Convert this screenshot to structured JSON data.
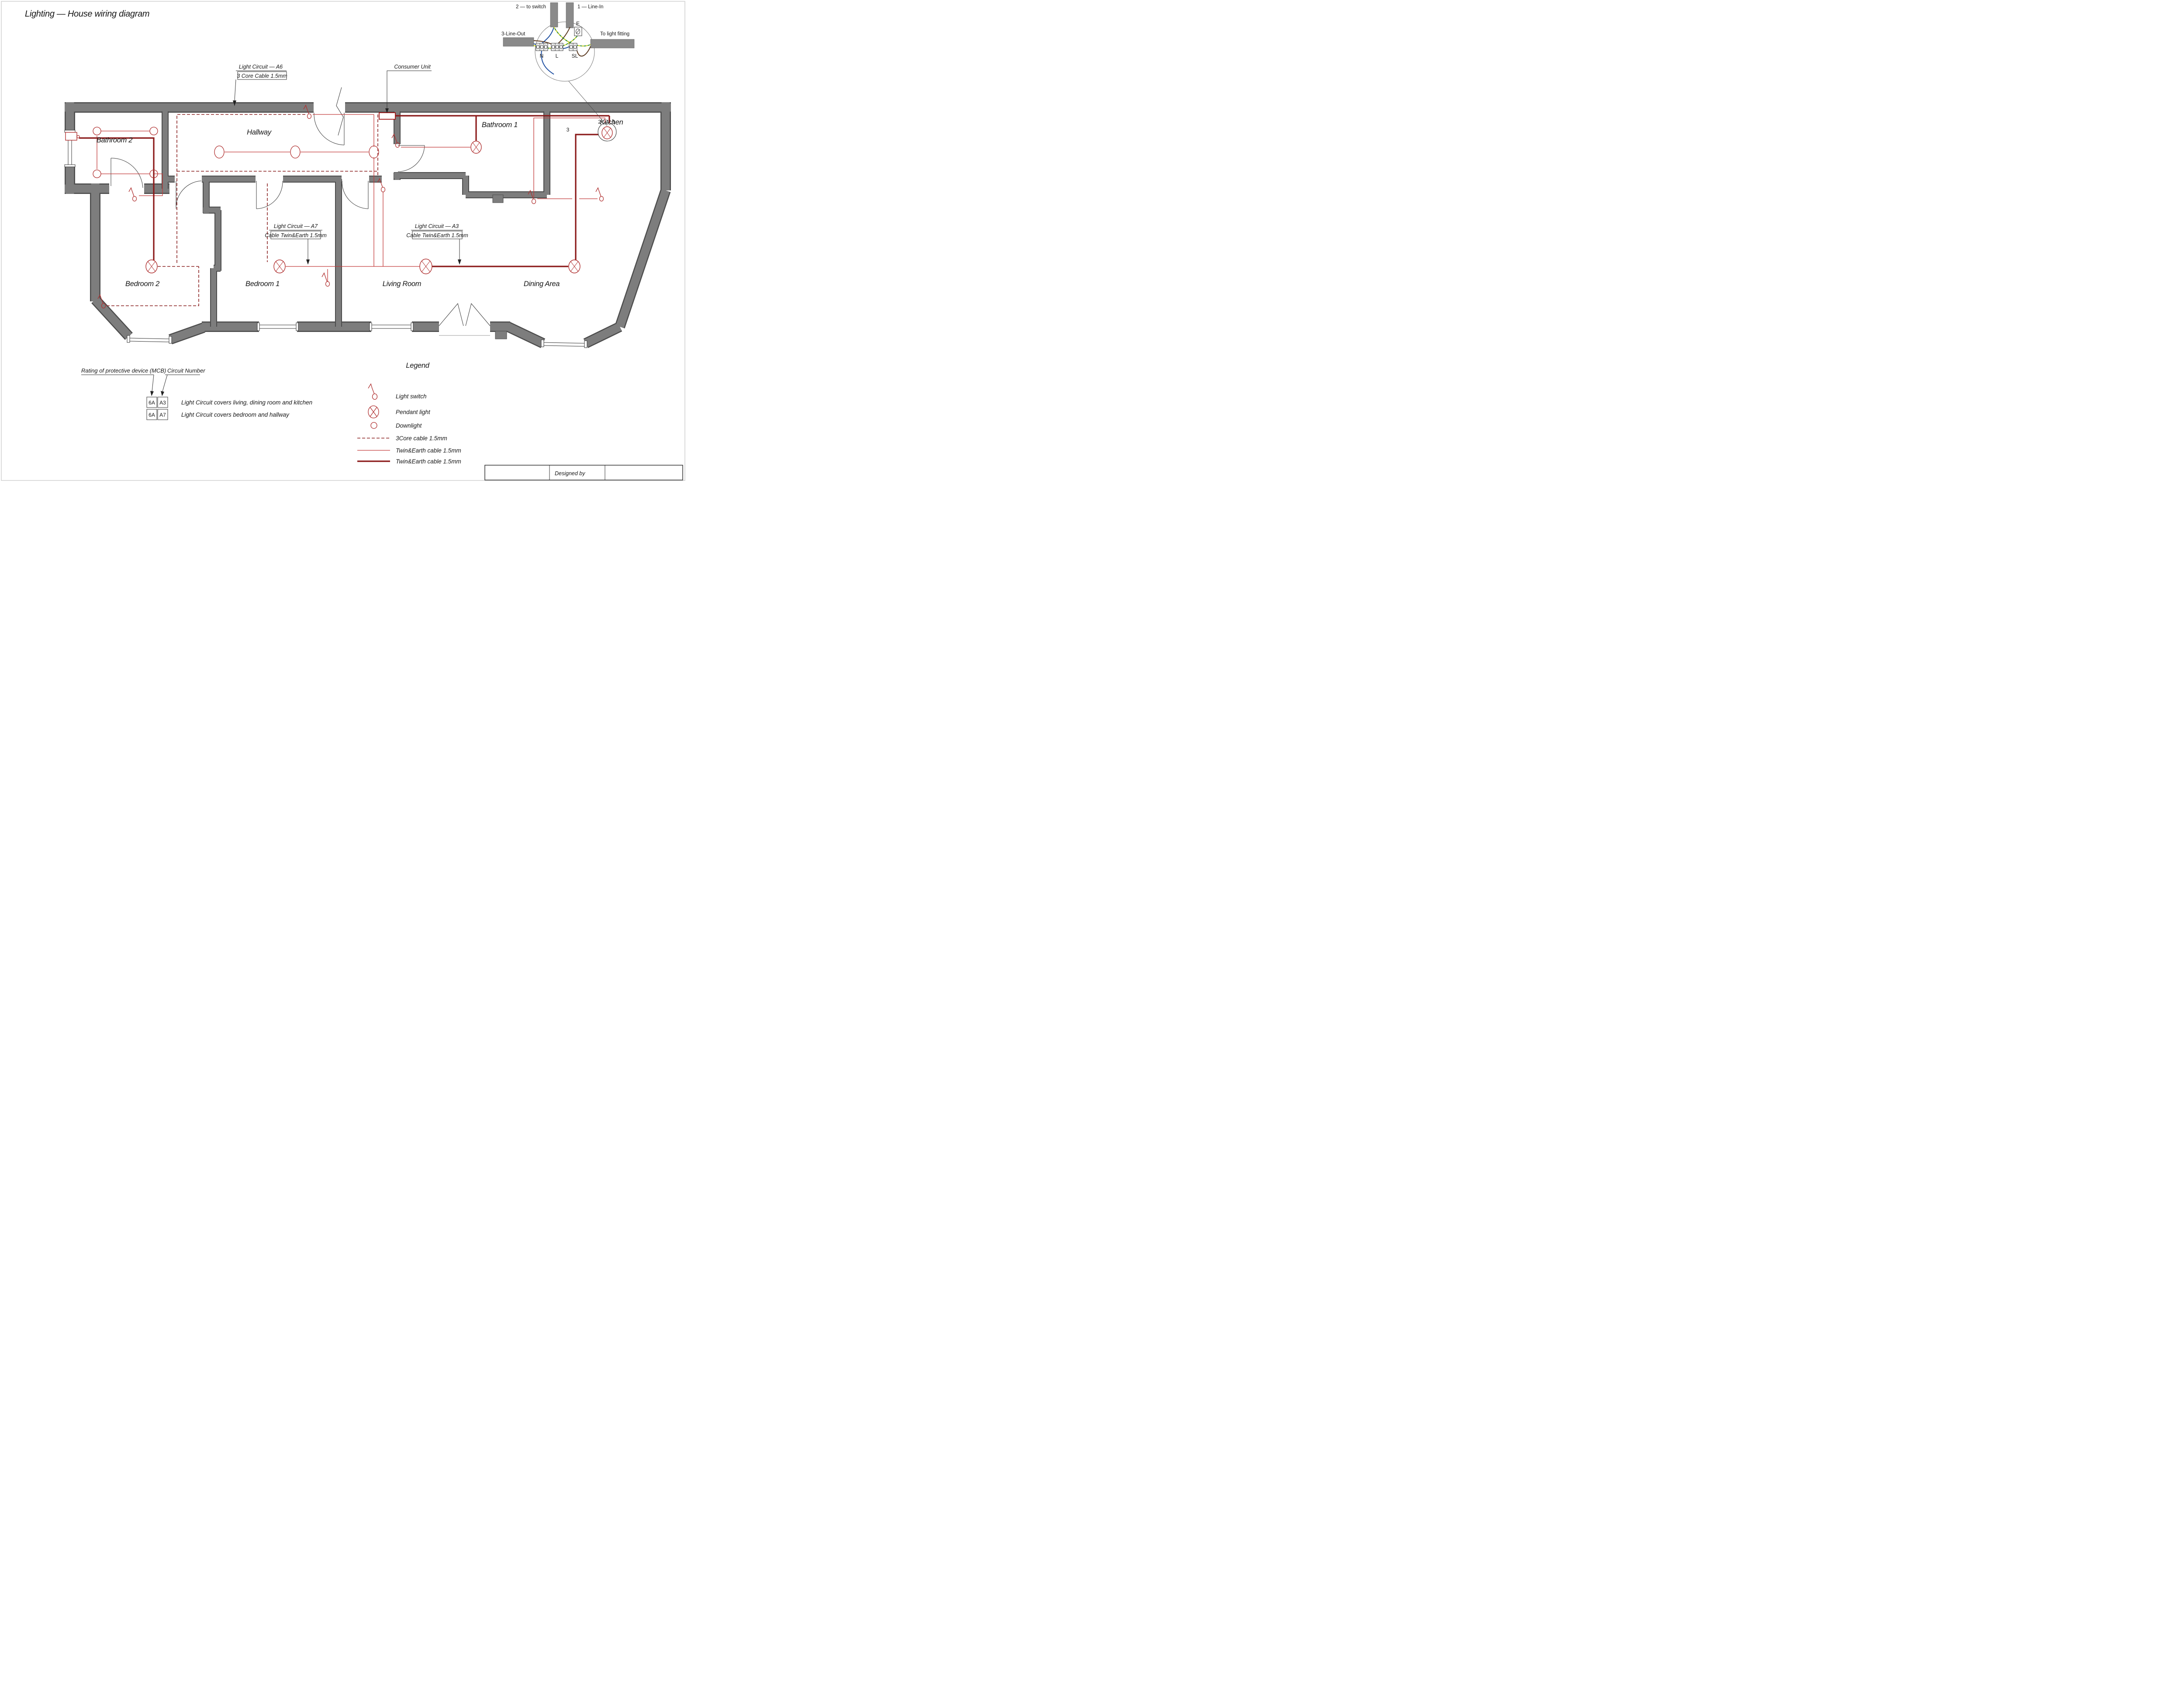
{
  "title": "Lighting — House wiring diagram",
  "ceiling_rose_detail": {
    "label_to_switch": "2 — to switch",
    "label_line_in": "1 — Line-In",
    "label_line_out": "3-Line-Out",
    "label_to_light_fitting": "To light fitting",
    "terminal_e": "E",
    "terminal_n": "N",
    "terminal_l": "L",
    "terminal_sl": "SL"
  },
  "callouts": {
    "a6_title": "Light Circuit — A6",
    "a6_sub": "3 Core Cable 1.5mm",
    "consumer_unit": "Consumer Unit",
    "a7_title": "Light Circuit — A7",
    "a7_sub": "Cable Twin&Earth 1.5mm",
    "a3_title": "Light Circuit — A3",
    "a3_sub": "Cable Twin&Earth 1.5mm"
  },
  "rooms": [
    "Bathroom 2",
    "Hallway",
    "Bathroom 1",
    "Kitchen",
    "Bedroom 2",
    "Bedroom 1",
    "Living Room",
    "Dining Area"
  ],
  "wire_numbers": {
    "kitchen_switch_wire": "2",
    "kitchen_line_in": "1",
    "kitchen_line_out": "3"
  },
  "mcb": {
    "rating_header": "Rating of protective device (MCB)",
    "circuit_header": "Circuit Number",
    "rows": [
      {
        "rating": "6A",
        "circuit": "A3",
        "description": "Light Circuit covers living, dining room and kitchen"
      },
      {
        "rating": "6A",
        "circuit": "A7",
        "description": "Light Circuit covers bedroom and hallway"
      }
    ]
  },
  "legend": {
    "title": "Legend",
    "items": [
      {
        "symbol": "light-switch-icon",
        "label": "Light switch"
      },
      {
        "symbol": "pendant-light-icon",
        "label": "Pendant light"
      },
      {
        "symbol": "downlight-icon",
        "label": "Downlight"
      },
      {
        "symbol": "cable-3core-dashed-icon",
        "label": "3Core cable 1.5mm"
      },
      {
        "symbol": "cable-twin-earth-thin-icon",
        "label": "Twin&Earth cable 1.5mm"
      },
      {
        "symbol": "cable-twin-earth-thick-icon",
        "label": "Twin&Earth cable 1.5mm"
      }
    ]
  },
  "footer": {
    "designed_by": "Designed by"
  },
  "colors": {
    "wall": "#7d7d7d",
    "wire_thick": "#8b1a1a",
    "wire_thin": "#c23b3b",
    "wire_dashed": "#8b2222",
    "wire_blue": "#1d4ea0",
    "wire_brown": "#5b3a21",
    "wire_earth_green": "#2e8b2e",
    "wire_earth_yellow": "#e6e020"
  }
}
